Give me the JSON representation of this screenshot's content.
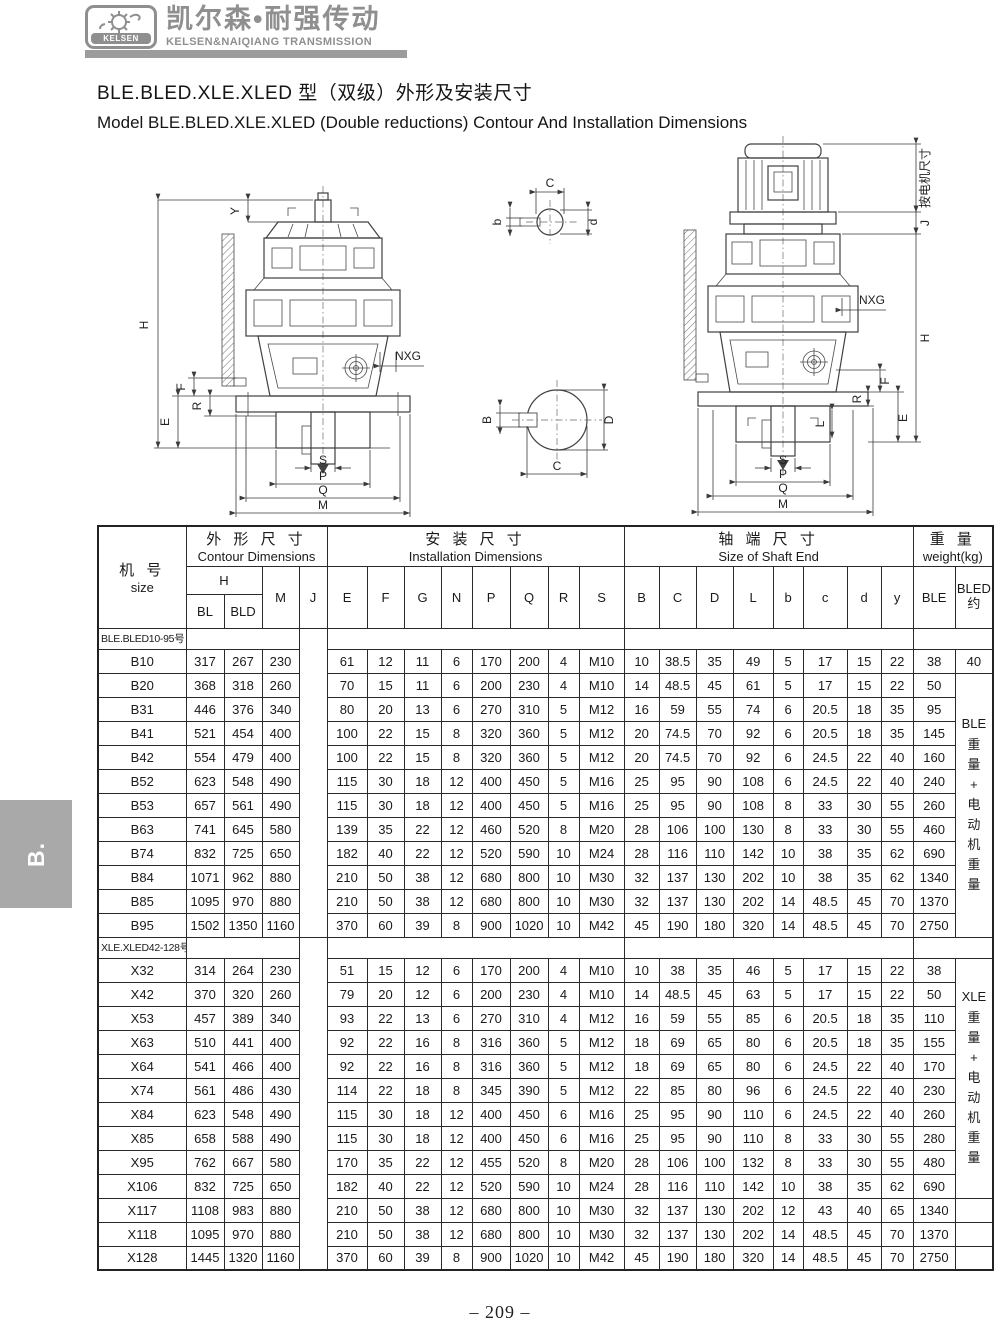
{
  "colors": {
    "brand_gray": "#8f8f8f",
    "bar_gray": "#9c9c9c",
    "tab_gray": "#a9a9a9",
    "line_black": "#222222"
  },
  "brand": {
    "logo_text": "KELSEN",
    "name_cn": "凯尔森•耐强传动",
    "name_en": "KELSEN&NAIQIANG TRANSMISSION"
  },
  "title": {
    "line_cn": "BLE.BLED.XLE.XLED 型（双级）外形及安装尺寸",
    "line_en": "Model BLE.BLED.XLE.XLED (Double reductions) Contour And Installation Dimensions"
  },
  "side_tab": {
    "label": "B."
  },
  "footer": {
    "page_number": "– 209 –"
  },
  "drawings": {
    "labels": {
      "H": "H",
      "Y": "Y",
      "E": "E",
      "F": "F",
      "R": "R",
      "NXG": "NXG",
      "S": "S",
      "P": "P",
      "Q": "Q",
      "M": "M",
      "J": "J",
      "L": "L",
      "B": "B",
      "C": "C",
      "D": "D",
      "b": "b",
      "d": "d",
      "motor_note": "按电机尺寸"
    }
  },
  "table": {
    "header": {
      "size_cn": "机 号",
      "size_en": "size",
      "contour_cn": "外 形 尺 寸",
      "contour_en": "Contour Dimensions",
      "install_cn": "安 装 尺 寸",
      "install_en": "Installation Dimensions",
      "shaft_cn": "轴 端 尺 寸",
      "shaft_en": "Size of Shaft End",
      "weight_cn": "重 量",
      "weight_en": "weight(kg)",
      "h": "H",
      "bl": "BL",
      "bld": "BLD",
      "m": "M",
      "j": "J",
      "cols": [
        "E",
        "F",
        "G",
        "N",
        "P",
        "Q",
        "R",
        "S",
        "B",
        "C",
        "D",
        "L",
        "b",
        "c",
        "d",
        "y"
      ],
      "ble": "BLE",
      "bled": "BLED\n约"
    },
    "sections": [
      {
        "label": "BLE.BLED10-95号",
        "bled": {
          "lead": "40",
          "vertical": "BLE\n重\n量\n+\n电\n动\n机\n重\n量",
          "span": 11,
          "tail": 0
        },
        "rows": [
          {
            "size": "B10",
            "values": [
              317,
              267,
              230,
              61,
              12,
              11,
              6,
              170,
              200,
              4,
              "M10",
              10,
              38.5,
              35,
              49,
              5,
              17,
              15,
              22,
              38
            ]
          },
          {
            "size": "B20",
            "values": [
              368,
              318,
              260,
              70,
              15,
              11,
              6,
              200,
              230,
              4,
              "M10",
              14,
              48.5,
              45,
              61,
              5,
              17,
              15,
              22,
              50
            ]
          },
          {
            "size": "B31",
            "values": [
              446,
              376,
              340,
              80,
              20,
              13,
              6,
              270,
              310,
              5,
              "M12",
              16,
              59,
              55,
              74,
              6,
              20.5,
              18,
              35,
              95
            ]
          },
          {
            "size": "B41",
            "values": [
              521,
              454,
              400,
              100,
              22,
              15,
              8,
              320,
              360,
              5,
              "M12",
              20,
              74.5,
              70,
              92,
              6,
              20.5,
              18,
              35,
              145
            ]
          },
          {
            "size": "B42",
            "values": [
              554,
              479,
              400,
              100,
              22,
              15,
              8,
              320,
              360,
              5,
              "M12",
              20,
              74.5,
              70,
              92,
              6,
              24.5,
              22,
              40,
              160
            ]
          },
          {
            "size": "B52",
            "values": [
              623,
              548,
              490,
              115,
              30,
              18,
              12,
              400,
              450,
              5,
              "M16",
              25,
              95,
              90,
              108,
              6,
              24.5,
              22,
              40,
              240
            ]
          },
          {
            "size": "B53",
            "values": [
              657,
              561,
              490,
              115,
              30,
              18,
              12,
              400,
              450,
              5,
              "M16",
              25,
              95,
              90,
              108,
              8,
              33,
              30,
              55,
              260
            ]
          },
          {
            "size": "B63",
            "values": [
              741,
              645,
              580,
              139,
              35,
              22,
              12,
              460,
              520,
              8,
              "M20",
              28,
              106,
              100,
              130,
              8,
              33,
              30,
              55,
              460
            ]
          },
          {
            "size": "B74",
            "values": [
              832,
              725,
              650,
              182,
              40,
              22,
              12,
              520,
              590,
              10,
              "M24",
              28,
              116,
              110,
              142,
              10,
              38,
              35,
              62,
              690
            ]
          },
          {
            "size": "B84",
            "values": [
              1071,
              962,
              880,
              210,
              50,
              38,
              12,
              680,
              800,
              10,
              "M30",
              32,
              137,
              130,
              202,
              10,
              38,
              35,
              62,
              1340
            ]
          },
          {
            "size": "B85",
            "values": [
              1095,
              970,
              880,
              210,
              50,
              38,
              12,
              680,
              800,
              10,
              "M30",
              32,
              137,
              130,
              202,
              14,
              48.5,
              45,
              70,
              1370
            ]
          },
          {
            "size": "B95",
            "values": [
              1502,
              1350,
              1160,
              370,
              60,
              39,
              8,
              900,
              1020,
              10,
              "M42",
              45,
              190,
              180,
              320,
              14,
              48.5,
              45,
              70,
              2750
            ]
          }
        ]
      },
      {
        "label": "XLE.XLED42-128号",
        "bled": {
          "lead": null,
          "vertical": "XLE\n重\n量\n+\n电\n动\n机\n重\n量",
          "span": 10,
          "tail": 3
        },
        "rows": [
          {
            "size": "X32",
            "values": [
              314,
              264,
              230,
              51,
              15,
              12,
              6,
              170,
              200,
              4,
              "M10",
              10,
              38,
              35,
              46,
              5,
              17,
              15,
              22,
              38
            ]
          },
          {
            "size": "X42",
            "values": [
              370,
              320,
              260,
              79,
              20,
              12,
              6,
              200,
              230,
              4,
              "M10",
              14,
              48.5,
              45,
              63,
              5,
              17,
              15,
              22,
              50
            ]
          },
          {
            "size": "X53",
            "values": [
              457,
              389,
              340,
              93,
              22,
              13,
              6,
              270,
              310,
              4,
              "M12",
              16,
              59,
              55,
              85,
              6,
              20.5,
              18,
              35,
              110
            ]
          },
          {
            "size": "X63",
            "values": [
              510,
              441,
              400,
              92,
              22,
              16,
              8,
              316,
              360,
              5,
              "M12",
              18,
              69,
              65,
              80,
              6,
              20.5,
              18,
              35,
              155
            ]
          },
          {
            "size": "X64",
            "values": [
              541,
              466,
              400,
              92,
              22,
              16,
              8,
              316,
              360,
              5,
              "M12",
              18,
              69,
              65,
              80,
              6,
              24.5,
              22,
              40,
              170
            ]
          },
          {
            "size": "X74",
            "values": [
              561,
              486,
              430,
              114,
              22,
              18,
              8,
              345,
              390,
              5,
              "M12",
              22,
              85,
              80,
              96,
              6,
              24.5,
              22,
              40,
              230
            ]
          },
          {
            "size": "X84",
            "values": [
              623,
              548,
              490,
              115,
              30,
              18,
              12,
              400,
              450,
              6,
              "M16",
              25,
              95,
              90,
              110,
              6,
              24.5,
              22,
              40,
              260
            ]
          },
          {
            "size": "X85",
            "values": [
              658,
              588,
              490,
              115,
              30,
              18,
              12,
              400,
              450,
              6,
              "M16",
              25,
              95,
              90,
              110,
              8,
              33,
              30,
              55,
              280
            ]
          },
          {
            "size": "X95",
            "values": [
              762,
              667,
              580,
              170,
              35,
              22,
              12,
              455,
              520,
              8,
              "M20",
              28,
              106,
              100,
              132,
              8,
              33,
              30,
              55,
              480
            ]
          },
          {
            "size": "X106",
            "values": [
              832,
              725,
              650,
              182,
              40,
              22,
              12,
              520,
              590,
              10,
              "M24",
              28,
              116,
              110,
              142,
              10,
              38,
              35,
              62,
              690
            ]
          },
          {
            "size": "X117",
            "values": [
              1108,
              983,
              880,
              210,
              50,
              38,
              12,
              680,
              800,
              10,
              "M30",
              32,
              137,
              130,
              202,
              12,
              43,
              40,
              65,
              1340
            ]
          },
          {
            "size": "X118",
            "values": [
              1095,
              970,
              880,
              210,
              50,
              38,
              12,
              680,
              800,
              10,
              "M30",
              32,
              137,
              130,
              202,
              14,
              48.5,
              45,
              70,
              1370
            ]
          },
          {
            "size": "X128",
            "values": [
              1445,
              1320,
              1160,
              370,
              60,
              39,
              8,
              900,
              1020,
              10,
              "M42",
              45,
              190,
              180,
              320,
              14,
              48.5,
              45,
              70,
              2750
            ]
          }
        ]
      }
    ]
  }
}
